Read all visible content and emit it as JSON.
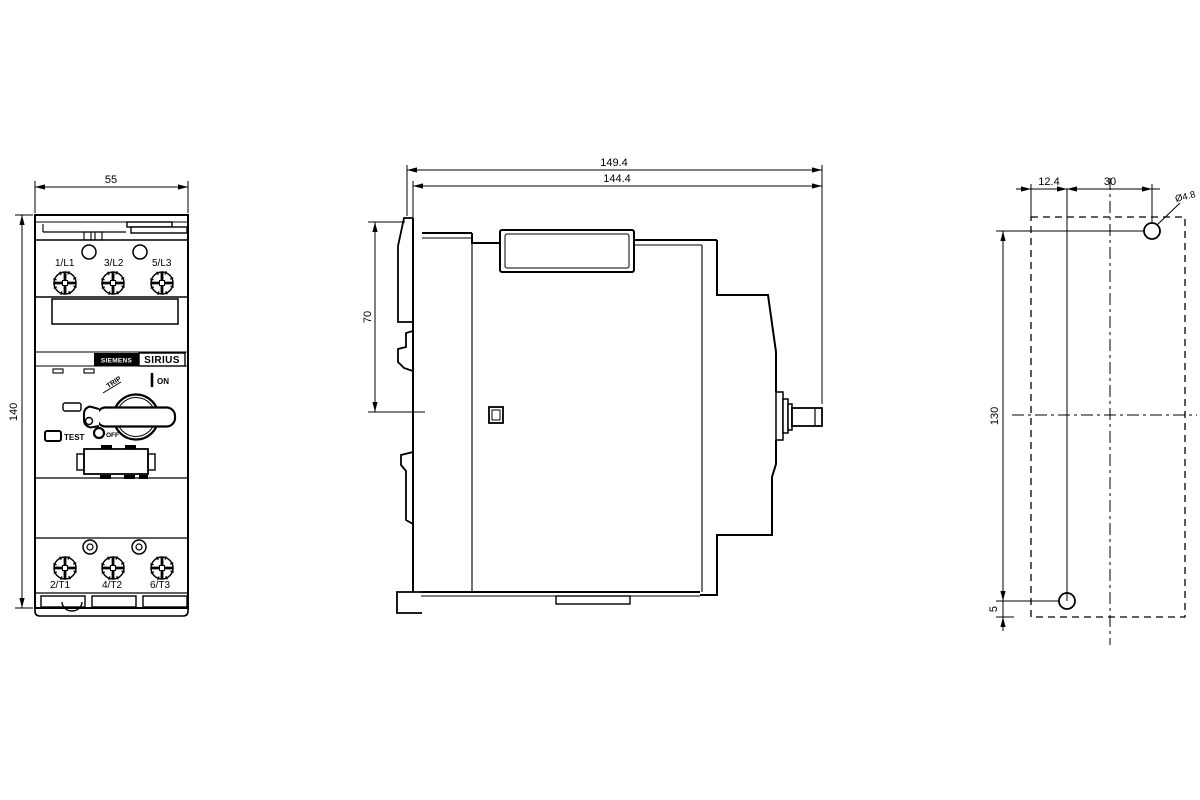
{
  "front_view": {
    "width_dim": "55",
    "height_dim": "140",
    "terminals_top": [
      "1/L1",
      "3/L2",
      "5/L3"
    ],
    "terminals_bottom": [
      "2/T1",
      "4/T2",
      "6/T3"
    ],
    "brand": "SIEMENS",
    "series": "SIRIUS",
    "labels": {
      "test": "TEST",
      "on": "ON",
      "off": "OFF",
      "trip": "TRIP"
    }
  },
  "side_view": {
    "total_depth_dim": "149.4",
    "mounting_depth_dim": "144.4",
    "top_to_handle_dim": "70"
  },
  "drill_plan": {
    "hole_offset_dim": "12.4",
    "hole_spacing_dim": "30",
    "hole_diameter_dim": "Ø4.8",
    "vertical_spacing_dim": "130",
    "bottom_offset_dim": "5"
  },
  "colors": {
    "line": "#000000",
    "background": "#ffffff"
  }
}
